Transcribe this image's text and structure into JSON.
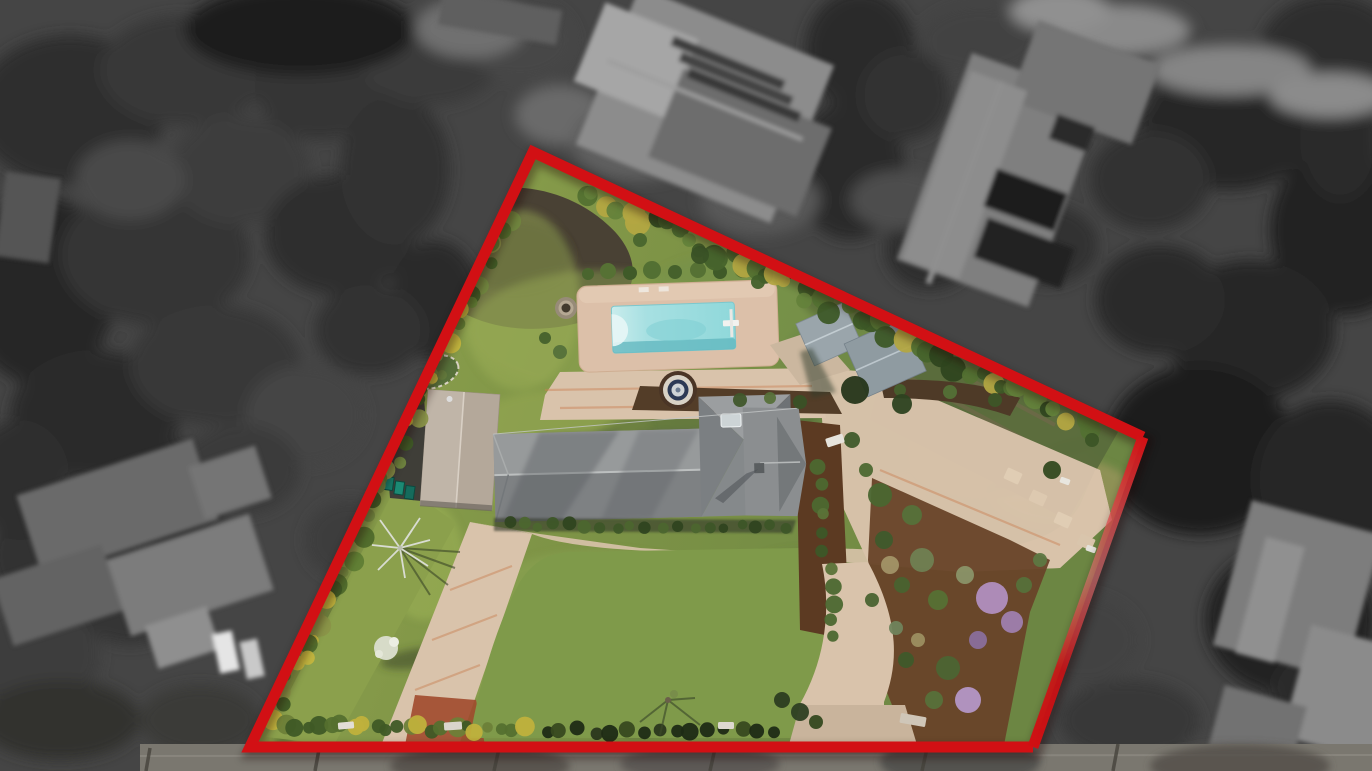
{
  "meta": {
    "title": "Aerial drone photograph of residential property with highlighted lot boundary",
    "type": "real-estate-aerial-photograph",
    "width": 1372,
    "height": 771
  },
  "palette": {
    "outside_base": "#454545",
    "road": "#7a776f",
    "curb": "#8f8b83",
    "lawn_green": "#7d9346",
    "lawn_front": "#7f9a4a",
    "lawn_bright": "#8ba04c",
    "dirt": "#494134",
    "mulch": "#69452a",
    "mulch_strip": "#5c3a22",
    "driveway": "#d9c3ab",
    "brick": "#a04a2c",
    "deck": "#dcc0a9",
    "pool_light": "#c9ecec",
    "pool_aqua": "#8fd8da",
    "pool_shadow": "#5fb6bd",
    "roof_gray": "#8d9091",
    "roof_dark": "#6e7275",
    "garage_roof": "#b4a89a",
    "shed_gray": "#9aa5ab",
    "veg_garden": "#5a6c3c",
    "gravel_dark": "#3f3e38",
    "bin_teal": "#1b8a74"
  },
  "boundary": {
    "points": "533,152 1143,437 1033,747 250,747",
    "open_path": "M1143,437 L533,152 L250,747 L1033,747",
    "right_edge": {
      "x1": 1143,
      "y1": 437,
      "x2": 1033,
      "y2": 747
    },
    "color": "#d21014",
    "stroke_width": 11
  },
  "outside": {
    "tree_blobs": [
      [
        70,
        110,
        95,
        75,
        "#2e2e2e"
      ],
      [
        185,
        70,
        85,
        55,
        "#383838"
      ],
      [
        40,
        290,
        75,
        95,
        "#282828"
      ],
      [
        155,
        255,
        95,
        70,
        "#343434"
      ],
      [
        95,
        415,
        85,
        65,
        "#2c2c2c"
      ],
      [
        240,
        170,
        70,
        55,
        "#3e3e3e"
      ],
      [
        320,
        85,
        65,
        55,
        "#363636"
      ],
      [
        340,
        235,
        75,
        60,
        "#2f2f2f"
      ],
      [
        215,
        365,
        85,
        60,
        "#373737"
      ],
      [
        65,
        555,
        75,
        65,
        "#313131"
      ],
      [
        165,
        495,
        65,
        55,
        "#2a2a2a"
      ],
      [
        35,
        655,
        65,
        55,
        "#3d3d3d"
      ],
      [
        305,
        415,
        60,
        50,
        "#454545"
      ],
      [
        395,
        170,
        55,
        75,
        "#303030"
      ],
      [
        435,
        300,
        45,
        60,
        "#2b2b2b"
      ],
      [
        370,
        330,
        55,
        45,
        "#333333"
      ],
      [
        430,
        60,
        70,
        45,
        "#3a3a3a"
      ],
      [
        520,
        40,
        55,
        40,
        "#474747"
      ],
      [
        560,
        115,
        45,
        30,
        "#6a6a6a"
      ],
      [
        860,
        50,
        55,
        60,
        "#2a2a2a"
      ],
      [
        850,
        170,
        55,
        70,
        "#2c2c2c"
      ],
      [
        905,
        95,
        45,
        45,
        "#333333"
      ],
      [
        980,
        40,
        60,
        35,
        "#424242"
      ],
      [
        1120,
        50,
        80,
        50,
        "#303030"
      ],
      [
        1230,
        120,
        90,
        70,
        "#262626"
      ],
      [
        1330,
        50,
        70,
        55,
        "#2e2e2e"
      ],
      [
        1345,
        230,
        75,
        85,
        "#202020"
      ],
      [
        1250,
        330,
        85,
        70,
        "#272727"
      ],
      [
        1160,
        300,
        65,
        55,
        "#2b2b2b"
      ],
      [
        1200,
        450,
        95,
        85,
        "#1f1f1f"
      ],
      [
        1330,
        480,
        75,
        80,
        "#252525"
      ],
      [
        1290,
        620,
        85,
        75,
        "#232323"
      ],
      [
        1340,
        700,
        70,
        60,
        "#2a2a2a"
      ],
      [
        1150,
        180,
        60,
        50,
        "#323232"
      ],
      [
        1100,
        90,
        55,
        40,
        "#3b3b3b"
      ],
      [
        300,
        30,
        115,
        45,
        "#1d1d1d"
      ],
      [
        470,
        28,
        55,
        30,
        "#6f6f6f"
      ],
      [
        240,
        470,
        60,
        45,
        "#3a3a3a"
      ],
      [
        130,
        600,
        55,
        45,
        "#343434"
      ],
      [
        60,
        720,
        80,
        40,
        "#30302e"
      ],
      [
        200,
        720,
        60,
        35,
        "#3a3a38"
      ],
      [
        1080,
        640,
        60,
        45,
        "#424242"
      ],
      [
        1130,
        720,
        70,
        40,
        "#393937"
      ],
      [
        1340,
        140,
        40,
        60,
        "#2a2a2a"
      ],
      [
        1048,
        245,
        50,
        40,
        "#303030"
      ],
      [
        930,
        250,
        45,
        40,
        "#2e2e2e"
      ],
      [
        1010,
        140,
        45,
        35,
        "#383838"
      ],
      [
        640,
        140,
        70,
        40,
        "#616161"
      ],
      [
        760,
        200,
        60,
        35,
        "#585858"
      ],
      [
        900,
        200,
        50,
        30,
        "#4e4e4e"
      ],
      [
        1120,
        30,
        70,
        25,
        "#8a8a8a"
      ],
      [
        1230,
        70,
        80,
        25,
        "#858585"
      ],
      [
        1330,
        95,
        60,
        22,
        "#8b8b8b"
      ],
      [
        1060,
        10,
        50,
        22,
        "#909090"
      ],
      [
        130,
        180,
        55,
        40,
        "#4a4a4a"
      ],
      [
        20,
        480,
        50,
        60,
        "#2e2e2e"
      ],
      [
        350,
        540,
        45,
        40,
        "#3c3c3c"
      ],
      [
        1260,
        760,
        90,
        25,
        "#4a4a48"
      ]
    ],
    "roofs": [
      [
        600,
        20,
        210,
        170,
        22,
        "#8c8c8c"
      ],
      [
        586,
        18,
        100,
        85,
        22,
        "#a6a6a6"
      ],
      [
        660,
        95,
        160,
        95,
        22,
        "#6d6d6d"
      ],
      [
        668,
        58,
        120,
        10,
        22,
        "#3c3c3c"
      ],
      [
        676,
        74,
        120,
        10,
        22,
        "#424242"
      ],
      [
        684,
        90,
        120,
        10,
        22,
        "#393939"
      ],
      [
        600,
        98,
        210,
        4,
        22,
        "#9e9e9e"
      ],
      [
        930,
        70,
        140,
        220,
        20,
        "#7f7f7f"
      ],
      [
        1020,
        40,
        130,
        85,
        20,
        "#757575"
      ],
      [
        935,
        75,
        60,
        200,
        20,
        "#8d8d8d"
      ],
      [
        988,
        180,
        75,
        40,
        20,
        "#1c1c1c"
      ],
      [
        978,
        232,
        92,
        42,
        20,
        "#212121"
      ],
      [
        1052,
        120,
        40,
        26,
        20,
        "#2a2a2a"
      ],
      [
        962,
        75,
        6,
        215,
        20,
        "#8f8f8f"
      ],
      [
        25,
        465,
        185,
        85,
        -18,
        "#6b6b6b"
      ],
      [
        115,
        535,
        150,
        80,
        -18,
        "#7b7b7b"
      ],
      [
        0,
        560,
        115,
        70,
        -18,
        "#646464"
      ],
      [
        150,
        615,
        65,
        45,
        -18,
        "#8f8f8f"
      ],
      [
        195,
        455,
        70,
        55,
        -18,
        "#747474"
      ],
      [
        216,
        632,
        20,
        40,
        -12,
        "#e5e5e5"
      ],
      [
        243,
        640,
        18,
        38,
        -12,
        "#c9c9c9"
      ],
      [
        1230,
        515,
        135,
        150,
        15,
        "#7d7d7d"
      ],
      [
        1295,
        635,
        95,
        115,
        15,
        "#8b8b8b"
      ],
      [
        1215,
        695,
        85,
        65,
        15,
        "#727272"
      ],
      [
        1250,
        540,
        40,
        120,
        15,
        "#909090"
      ],
      [
        440,
        0,
        120,
        35,
        10,
        "#5e5e5e"
      ],
      [
        0,
        175,
        55,
        85,
        8,
        "#555555"
      ]
    ],
    "pole_shadows": [
      [
        500,
        744,
        494,
        771
      ],
      [
        716,
        744,
        710,
        771
      ],
      [
        928,
        744,
        922,
        771
      ],
      [
        1118,
        744,
        1113,
        771
      ],
      [
        320,
        744,
        315,
        771
      ],
      [
        150,
        748,
        146,
        771
      ]
    ],
    "pole_color": "#46433c",
    "road_shadow_blobs": [
      [
        480,
        766,
        90,
        20,
        "#514e48"
      ],
      [
        700,
        764,
        80,
        18,
        "#55534f"
      ],
      [
        960,
        762,
        80,
        25,
        "#4a4a48"
      ],
      [
        1240,
        766,
        90,
        22,
        "#514e48"
      ]
    ]
  },
  "property": {
    "features": [
      "main house with gray tile roof",
      "detached garage",
      "swimming pool with diving board",
      "pool deck",
      "round fountain",
      "fire pit",
      "circular driveway around front lawn",
      "front lawn oval",
      "rear lawn",
      "two metal storage sheds",
      "vegetable garden rows near east corner",
      "mulch garden with purple flowering shrubs",
      "boundary hedges with yellow flowers",
      "two street entrances",
      "green trash bins",
      "bare winter trees"
    ],
    "hedges": [
      {
        "x1": 516,
        "y1": 192,
        "x2": 276,
        "y2": 714,
        "n": 48,
        "rmin": 5,
        "rmax": 11,
        "jitter": 7,
        "colors": [
          "#4f6a2b",
          "#5f7d34",
          "#71863f",
          "#c4b53e",
          "#3f5a25",
          "#8a9448"
        ]
      },
      {
        "x1": 585,
        "y1": 192,
        "x2": 1092,
        "y2": 424,
        "n": 46,
        "rmin": 6,
        "rmax": 13,
        "jitter": 8,
        "colors": [
          "#3d5827",
          "#537132",
          "#64823b",
          "#2f461f",
          "#b3a642",
          "#47642c"
        ]
      },
      {
        "x1": 286,
        "y1": 726,
        "x2": 522,
        "y2": 730,
        "n": 22,
        "rmin": 5,
        "rmax": 10,
        "jitter": 4,
        "colors": [
          "#55702f",
          "#6d8038",
          "#c0b13c",
          "#3f5a26"
        ]
      },
      {
        "x1": 545,
        "y1": 730,
        "x2": 772,
        "y2": 732,
        "n": 15,
        "rmin": 5,
        "rmax": 9,
        "jitter": 4,
        "colors": [
          "#2b371c",
          "#1f2b15",
          "#38491f"
        ]
      },
      {
        "x1": 508,
        "y1": 525,
        "x2": 786,
        "y2": 527,
        "n": 19,
        "rmin": 4,
        "rmax": 7,
        "jitter": 3,
        "colors": [
          "#2f4420",
          "#3d5628",
          "#4c662f"
        ]
      },
      {
        "x1": 818,
        "y1": 468,
        "x2": 834,
        "y2": 636,
        "n": 11,
        "rmin": 5,
        "rmax": 9,
        "jitter": 5,
        "colors": [
          "#3c5728",
          "#4c6830",
          "#5b7338"
        ]
      }
    ],
    "topiary": [
      [
        588,
        274,
        6,
        "#4a652e"
      ],
      [
        608,
        271,
        8,
        "#567134"
      ],
      [
        630,
        273,
        7,
        "#3f5a28"
      ],
      [
        652,
        270,
        9,
        "#537033"
      ],
      [
        675,
        272,
        7,
        "#46612c"
      ],
      [
        698,
        270,
        8,
        "#567134"
      ],
      [
        720,
        272,
        7,
        "#3f5a28"
      ],
      [
        743,
        269,
        9,
        "#526f33"
      ],
      [
        766,
        272,
        7,
        "#46612c"
      ],
      [
        787,
        274,
        6,
        "#3c5526"
      ]
    ],
    "mottles": [
      [
        600,
        330,
        130,
        60,
        0,
        "#8ba150",
        0.5
      ],
      [
        760,
        300,
        120,
        50,
        0,
        "#75914a",
        0.55
      ],
      [
        900,
        360,
        120,
        60,
        0,
        "#6c8747",
        0.55
      ],
      [
        520,
        300,
        60,
        90,
        0,
        "#9bad55",
        0.5
      ],
      [
        560,
        430,
        90,
        40,
        0,
        "#97a954",
        0.5
      ],
      [
        840,
        435,
        100,
        40,
        0,
        "#5e7a40",
        0.5
      ],
      [
        1000,
        450,
        90,
        45,
        0,
        "#948f58",
        0.65
      ],
      [
        1062,
        492,
        70,
        35,
        0,
        "#a59a63",
        0.6
      ],
      [
        700,
        432,
        120,
        35,
        -10,
        "#4c5f33",
        0.45
      ],
      [
        862,
        300,
        60,
        25,
        0,
        "#47552f",
        0.5
      ],
      [
        958,
        392,
        80,
        30,
        0,
        "#49582f",
        0.4
      ],
      [
        600,
        600,
        120,
        50,
        0,
        "#8ba452",
        0.55
      ],
      [
        752,
        640,
        120,
        60,
        0,
        "#6f8a43",
        0.55
      ],
      [
        560,
        680,
        90,
        50,
        0,
        "#93a855",
        0.5
      ],
      [
        800,
        580,
        60,
        30,
        0,
        "#66803e",
        0.5
      ],
      [
        424,
        560,
        40,
        60,
        0,
        "#9db257",
        0.55
      ],
      [
        330,
        640,
        70,
        14,
        -65,
        "#44552c",
        0.5
      ],
      [
        362,
        582,
        60,
        12,
        -65,
        "#44552c",
        0.45
      ],
      [
        302,
        700,
        60,
        12,
        -65,
        "#3f5128",
        0.45
      ],
      [
        660,
        716,
        50,
        18,
        -15,
        "#465531",
        0.5
      ],
      [
        1022,
        480,
        40,
        9,
        -15,
        "#3c512b",
        0.55
      ],
      [
        1068,
        448,
        30,
        8,
        -15,
        "#3c512b",
        0.5
      ],
      [
        420,
        658,
        40,
        10,
        -8,
        "#3a4527",
        0.55
      ],
      [
        500,
        480,
        60,
        25,
        0,
        "#8ea549",
        0.5
      ]
    ],
    "bushes": [
      [
        880,
        495,
        12,
        "#4a6630"
      ],
      [
        912,
        515,
        10,
        "#55713a"
      ],
      [
        884,
        540,
        9,
        "#3e5a2c"
      ],
      [
        922,
        560,
        12,
        "#6f7f52"
      ],
      [
        902,
        585,
        8,
        "#49632f"
      ],
      [
        938,
        600,
        10,
        "#567134"
      ],
      [
        965,
        575,
        9,
        "#8a9468"
      ],
      [
        992,
        598,
        16,
        "#b18fbf"
      ],
      [
        1012,
        622,
        11,
        "#9f7fae"
      ],
      [
        978,
        640,
        9,
        "#8a6f9b"
      ],
      [
        948,
        668,
        12,
        "#4c6533"
      ],
      [
        968,
        700,
        13,
        "#b497c6"
      ],
      [
        934,
        700,
        9,
        "#57713a"
      ],
      [
        906,
        660,
        8,
        "#3f5a2a"
      ],
      [
        1024,
        585,
        8,
        "#56713a"
      ],
      [
        896,
        628,
        7,
        "#70845c"
      ],
      [
        872,
        600,
        7,
        "#4a6330"
      ],
      [
        1040,
        560,
        7,
        "#5d7742"
      ],
      [
        890,
        565,
        9,
        "#a29467"
      ],
      [
        918,
        640,
        7,
        "#9c8f60"
      ],
      [
        740,
        400,
        7,
        "#40572b"
      ],
      [
        770,
        398,
        6,
        "#57713a"
      ],
      [
        800,
        402,
        7,
        "#3a5126"
      ],
      [
        900,
        390,
        6,
        "#46602c"
      ],
      [
        950,
        392,
        7,
        "#537036"
      ],
      [
        995,
        400,
        7,
        "#3d5527"
      ],
      [
        1052,
        470,
        9,
        "#33491f"
      ],
      [
        1092,
        440,
        7,
        "#3c5526"
      ],
      [
        800,
        712,
        9,
        "#2e3f22"
      ],
      [
        816,
        722,
        7,
        "#35491f"
      ],
      [
        782,
        700,
        8,
        "#2c3c20"
      ],
      [
        425,
        368,
        6,
        "#3c5526"
      ],
      [
        442,
        375,
        5,
        "#64793c"
      ],
      [
        855,
        390,
        14,
        "#26361a"
      ],
      [
        902,
        404,
        10,
        "#2d4220"
      ],
      [
        700,
        255,
        9,
        "#3a5226"
      ],
      [
        640,
        240,
        7,
        "#49652e"
      ],
      [
        758,
        282,
        7,
        "#42602a"
      ],
      [
        560,
        352,
        7,
        "#55713a"
      ],
      [
        545,
        338,
        6,
        "#46612c"
      ],
      [
        852,
        440,
        8,
        "#3f5a2a"
      ],
      [
        866,
        470,
        7,
        "#4c6830"
      ]
    ],
    "stones": [
      [
        1005,
        470,
        16,
        12,
        25,
        "#e0cdb4"
      ],
      [
        1030,
        492,
        16,
        12,
        25,
        "#ddc9b0"
      ],
      [
        1055,
        514,
        16,
        12,
        25,
        "#e0cdb4"
      ],
      [
        1078,
        536,
        16,
        12,
        25,
        "#d9c5ac"
      ],
      [
        338,
        722,
        16,
        7,
        -5,
        "#e2ded6"
      ],
      [
        444,
        722,
        18,
        8,
        -4,
        "#d9d5cc"
      ],
      [
        718,
        722,
        16,
        7,
        0,
        "#ddd9d0"
      ],
      [
        826,
        436,
        18,
        9,
        -18,
        "#e6e3dc"
      ],
      [
        1060,
        478,
        10,
        6,
        20,
        "#e8e6df"
      ],
      [
        1086,
        546,
        10,
        6,
        20,
        "#e3e1da"
      ],
      [
        900,
        715,
        26,
        10,
        10,
        "#cfc6b8"
      ]
    ]
  }
}
